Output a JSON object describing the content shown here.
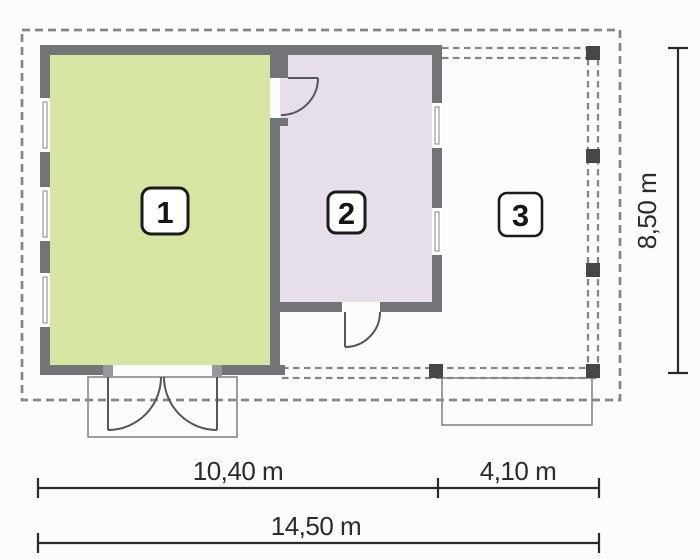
{
  "plan": {
    "title": "floor-plan",
    "rooms": [
      {
        "label": "1",
        "name": "room-1"
      },
      {
        "label": "2",
        "name": "room-2"
      },
      {
        "label": "3",
        "name": "room-3"
      }
    ],
    "dimensions": {
      "width_left": "10,40 m",
      "width_right": "4,10 m",
      "width_total": "14,50 m",
      "height": "8,50 m"
    },
    "colors": {
      "background": "#fcfcfc",
      "wall": "#737478",
      "wall_light": "#97989b",
      "room1_fill": "#d7e5a2",
      "room2_fill": "#e6dfe9",
      "dash": "#85868a",
      "post": "#464749",
      "door": "#55565a",
      "text": "#2b2b2b"
    }
  }
}
